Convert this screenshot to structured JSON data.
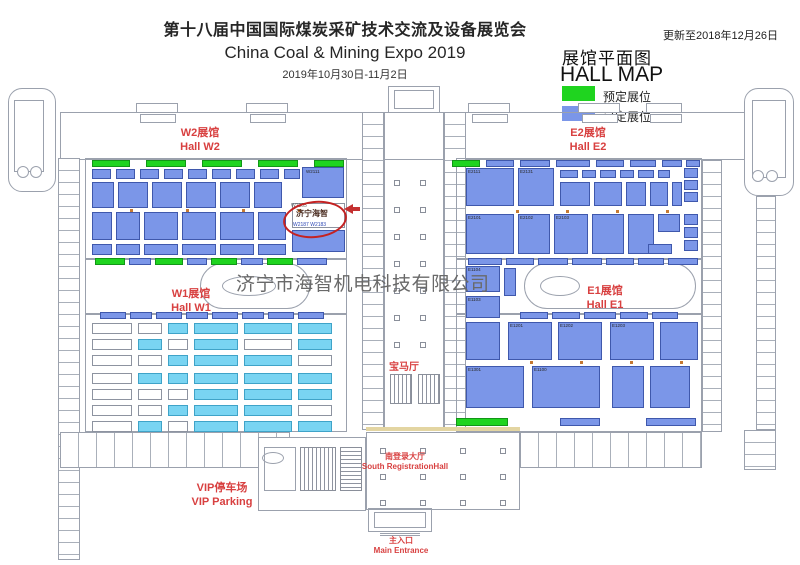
{
  "header": {
    "title_zh": "第十八届中国国际煤炭采矿技术交流及设备展览会",
    "title_en": "China Coal & Mining Expo 2019",
    "dates": "2019年10月30日-11月2日",
    "updated": "更新至2018年12月26日"
  },
  "legend": {
    "title_zh": "展馆平面图",
    "title_en": "HALL MAP",
    "items": [
      {
        "label": "预定展位",
        "color": "#1fd41f"
      },
      {
        "label": "已定展位",
        "color": "#7b96e8"
      }
    ]
  },
  "halls": {
    "w2": {
      "zh": "W2展馆",
      "en": "Hall W2"
    },
    "e2": {
      "zh": "E2展馆",
      "en": "Hall E2"
    },
    "w1": {
      "zh": "W1展馆",
      "en": "Hall W1"
    },
    "e1": {
      "zh": "E1展馆",
      "en": "Hall E1"
    }
  },
  "places": {
    "bmw_hall": "宝马厅",
    "south_hall_zh": "南登录大厅",
    "south_hall_en": "South RegistrationHall",
    "vip_zh": "VIP停车场",
    "vip_en": "VIP Parking",
    "entrance_zh": "主入口",
    "entrance_en": "Main Entrance"
  },
  "highlight": {
    "booth_no": "W2105",
    "company": "济宁海智",
    "neighbor_booths": "W2187  W2183"
  },
  "watermark": "济宁市海智机电科技有限公司",
  "map": {
    "booths": [
      [
        92,
        160,
        38,
        7,
        "g"
      ],
      [
        146,
        160,
        40,
        7,
        "g"
      ],
      [
        202,
        160,
        40,
        7,
        "g"
      ],
      [
        258,
        160,
        40,
        7,
        "g"
      ],
      [
        314,
        160,
        30,
        7,
        "g"
      ],
      [
        452,
        160,
        28,
        7,
        "g"
      ],
      [
        486,
        160,
        28,
        7,
        "b"
      ],
      [
        520,
        160,
        30,
        7,
        "b"
      ],
      [
        556,
        160,
        34,
        7,
        "b"
      ],
      [
        596,
        160,
        28,
        7,
        "b"
      ],
      [
        630,
        160,
        26,
        7,
        "b"
      ],
      [
        662,
        160,
        20,
        7,
        "b"
      ],
      [
        686,
        160,
        14,
        7,
        "b"
      ],
      [
        92,
        169,
        19,
        10,
        "b"
      ],
      [
        116,
        169,
        19,
        10,
        "b"
      ],
      [
        140,
        169,
        19,
        10,
        "b"
      ],
      [
        164,
        169,
        19,
        10,
        "b"
      ],
      [
        188,
        169,
        19,
        10,
        "b"
      ],
      [
        212,
        169,
        19,
        10,
        "b"
      ],
      [
        236,
        169,
        19,
        10,
        "b"
      ],
      [
        260,
        169,
        19,
        10,
        "b"
      ],
      [
        284,
        169,
        16,
        10,
        "b"
      ],
      [
        302,
        167,
        42,
        31,
        "b"
      ],
      [
        92,
        182,
        22,
        26,
        "b"
      ],
      [
        118,
        182,
        30,
        26,
        "b"
      ],
      [
        152,
        182,
        30,
        26,
        "b"
      ],
      [
        186,
        182,
        30,
        26,
        "b"
      ],
      [
        220,
        182,
        30,
        26,
        "b"
      ],
      [
        254,
        182,
        28,
        26,
        "b"
      ],
      [
        92,
        212,
        20,
        28,
        "b"
      ],
      [
        116,
        212,
        24,
        28,
        "b"
      ],
      [
        144,
        212,
        34,
        28,
        "b"
      ],
      [
        182,
        212,
        34,
        28,
        "b"
      ],
      [
        220,
        212,
        34,
        28,
        "b"
      ],
      [
        258,
        212,
        28,
        28,
        "b"
      ],
      [
        292,
        203,
        53,
        25,
        "w"
      ],
      [
        292,
        230,
        53,
        22,
        "b"
      ],
      [
        92,
        244,
        20,
        11,
        "b"
      ],
      [
        116,
        244,
        24,
        11,
        "b"
      ],
      [
        144,
        244,
        34,
        11,
        "b"
      ],
      [
        182,
        244,
        34,
        11,
        "b"
      ],
      [
        220,
        244,
        34,
        11,
        "b"
      ],
      [
        258,
        244,
        28,
        11,
        "b"
      ],
      [
        95,
        258,
        30,
        7,
        "g"
      ],
      [
        129,
        258,
        22,
        7,
        "b"
      ],
      [
        155,
        258,
        28,
        7,
        "g"
      ],
      [
        187,
        258,
        20,
        7,
        "b"
      ],
      [
        211,
        258,
        26,
        7,
        "g"
      ],
      [
        241,
        258,
        22,
        7,
        "b"
      ],
      [
        267,
        258,
        26,
        7,
        "g"
      ],
      [
        297,
        258,
        30,
        7,
        "b"
      ],
      [
        466,
        168,
        48,
        38,
        "b"
      ],
      [
        518,
        168,
        36,
        38,
        "b"
      ],
      [
        560,
        170,
        18,
        8,
        "b"
      ],
      [
        582,
        170,
        14,
        8,
        "b"
      ],
      [
        600,
        170,
        16,
        8,
        "b"
      ],
      [
        620,
        170,
        14,
        8,
        "b"
      ],
      [
        638,
        170,
        16,
        8,
        "b"
      ],
      [
        658,
        170,
        12,
        8,
        "b"
      ],
      [
        560,
        182,
        30,
        24,
        "b"
      ],
      [
        594,
        182,
        28,
        24,
        "b"
      ],
      [
        626,
        182,
        20,
        24,
        "b"
      ],
      [
        650,
        182,
        18,
        24,
        "b"
      ],
      [
        672,
        182,
        10,
        24,
        "b"
      ],
      [
        684,
        168,
        14,
        10,
        "b"
      ],
      [
        684,
        180,
        14,
        10,
        "b"
      ],
      [
        684,
        192,
        14,
        10,
        "b"
      ],
      [
        466,
        214,
        48,
        40,
        "b"
      ],
      [
        518,
        214,
        32,
        40,
        "b"
      ],
      [
        554,
        214,
        34,
        40,
        "b"
      ],
      [
        592,
        214,
        32,
        40,
        "b"
      ],
      [
        628,
        214,
        26,
        40,
        "b"
      ],
      [
        658,
        214,
        22,
        18,
        "b"
      ],
      [
        684,
        214,
        14,
        11,
        "b"
      ],
      [
        684,
        227,
        14,
        11,
        "b"
      ],
      [
        684,
        240,
        14,
        11,
        "b"
      ],
      [
        648,
        244,
        24,
        10,
        "b"
      ],
      [
        468,
        258,
        34,
        7,
        "b"
      ],
      [
        506,
        258,
        28,
        7,
        "b"
      ],
      [
        538,
        258,
        30,
        7,
        "b"
      ],
      [
        572,
        258,
        30,
        7,
        "b"
      ],
      [
        606,
        258,
        28,
        7,
        "b"
      ],
      [
        638,
        258,
        26,
        7,
        "b"
      ],
      [
        668,
        258,
        30,
        7,
        "b"
      ],
      [
        466,
        266,
        34,
        26,
        "b"
      ],
      [
        466,
        296,
        34,
        22,
        "b"
      ],
      [
        504,
        268,
        12,
        28,
        "b"
      ],
      [
        520,
        312,
        28,
        7,
        "b"
      ],
      [
        552,
        312,
        28,
        7,
        "b"
      ],
      [
        584,
        312,
        32,
        7,
        "b"
      ],
      [
        620,
        312,
        28,
        7,
        "b"
      ],
      [
        652,
        312,
        26,
        7,
        "b"
      ],
      [
        100,
        312,
        26,
        7,
        "b"
      ],
      [
        130,
        312,
        22,
        7,
        "b"
      ],
      [
        156,
        312,
        26,
        7,
        "b"
      ],
      [
        186,
        312,
        22,
        7,
        "b"
      ],
      [
        212,
        312,
        26,
        7,
        "b"
      ],
      [
        242,
        312,
        22,
        7,
        "b"
      ],
      [
        268,
        312,
        26,
        7,
        "b"
      ],
      [
        298,
        312,
        26,
        7,
        "b"
      ],
      [
        466,
        322,
        34,
        38,
        "b"
      ],
      [
        508,
        322,
        44,
        38,
        "b"
      ],
      [
        558,
        322,
        44,
        38,
        "b"
      ],
      [
        610,
        322,
        44,
        38,
        "b"
      ],
      [
        660,
        322,
        38,
        38,
        "b"
      ],
      [
        466,
        366,
        58,
        42,
        "b"
      ],
      [
        532,
        366,
        68,
        42,
        "b"
      ],
      [
        612,
        366,
        32,
        42,
        "b"
      ],
      [
        650,
        366,
        40,
        42,
        "b"
      ],
      [
        456,
        418,
        52,
        8,
        "g"
      ],
      [
        560,
        418,
        40,
        8,
        "b"
      ],
      [
        646,
        418,
        50,
        8,
        "b"
      ],
      [
        92,
        323,
        40,
        11,
        "w"
      ],
      [
        92,
        339,
        40,
        11,
        "w"
      ],
      [
        92,
        355,
        40,
        11,
        "w"
      ],
      [
        92,
        373,
        40,
        11,
        "w"
      ],
      [
        92,
        389,
        40,
        11,
        "w"
      ],
      [
        92,
        405,
        40,
        11,
        "w"
      ],
      [
        92,
        421,
        40,
        11,
        "w"
      ],
      [
        138,
        323,
        24,
        11,
        "w"
      ],
      [
        138,
        339,
        24,
        11,
        "c"
      ],
      [
        138,
        355,
        24,
        11,
        "w"
      ],
      [
        138,
        373,
        24,
        11,
        "c"
      ],
      [
        138,
        389,
        24,
        11,
        "w"
      ],
      [
        138,
        405,
        24,
        11,
        "w"
      ],
      [
        138,
        421,
        24,
        11,
        "c"
      ],
      [
        168,
        323,
        20,
        11,
        "c"
      ],
      [
        168,
        339,
        20,
        11,
        "w"
      ],
      [
        168,
        355,
        20,
        11,
        "c"
      ],
      [
        168,
        373,
        20,
        11,
        "c"
      ],
      [
        168,
        389,
        20,
        11,
        "w"
      ],
      [
        168,
        405,
        20,
        11,
        "c"
      ],
      [
        168,
        421,
        20,
        11,
        "w"
      ],
      [
        194,
        323,
        44,
        11,
        "c"
      ],
      [
        194,
        339,
        44,
        11,
        "c"
      ],
      [
        194,
        355,
        44,
        11,
        "c"
      ],
      [
        194,
        373,
        44,
        11,
        "c"
      ],
      [
        194,
        389,
        44,
        11,
        "c"
      ],
      [
        194,
        405,
        44,
        11,
        "c"
      ],
      [
        194,
        421,
        44,
        11,
        "c"
      ],
      [
        244,
        323,
        48,
        11,
        "c"
      ],
      [
        244,
        339,
        48,
        11,
        "w"
      ],
      [
        244,
        355,
        48,
        11,
        "c"
      ],
      [
        244,
        373,
        48,
        11,
        "c"
      ],
      [
        244,
        389,
        48,
        11,
        "c"
      ],
      [
        244,
        405,
        48,
        11,
        "c"
      ],
      [
        244,
        421,
        48,
        11,
        "c"
      ],
      [
        298,
        323,
        34,
        11,
        "c"
      ],
      [
        298,
        339,
        34,
        11,
        "c"
      ],
      [
        298,
        355,
        34,
        11,
        "w"
      ],
      [
        298,
        373,
        34,
        11,
        "c"
      ],
      [
        298,
        389,
        34,
        11,
        "c"
      ],
      [
        298,
        405,
        34,
        11,
        "w"
      ],
      [
        298,
        421,
        34,
        11,
        "c"
      ]
    ],
    "booth_labels": [
      {
        "t": "W2111",
        "x": 306,
        "y": 170
      },
      {
        "t": "E2111",
        "x": 468,
        "y": 170
      },
      {
        "t": "E2131",
        "x": 520,
        "y": 170
      },
      {
        "t": "E2101",
        "x": 468,
        "y": 216
      },
      {
        "t": "E2102",
        "x": 520,
        "y": 216
      },
      {
        "t": "E2103",
        "x": 556,
        "y": 216
      },
      {
        "t": "E1104",
        "x": 468,
        "y": 268
      },
      {
        "t": "E1103",
        "x": 468,
        "y": 298
      },
      {
        "t": "E1201",
        "x": 510,
        "y": 324
      },
      {
        "t": "E1202",
        "x": 560,
        "y": 324
      },
      {
        "t": "E1203",
        "x": 612,
        "y": 324
      },
      {
        "t": "E1301",
        "x": 468,
        "y": 368
      },
      {
        "t": "E1100",
        "x": 534,
        "y": 368
      }
    ],
    "dots": [
      [
        130,
        209
      ],
      [
        186,
        209
      ],
      [
        242,
        209
      ],
      [
        298,
        209
      ],
      [
        516,
        210
      ],
      [
        566,
        210
      ],
      [
        616,
        210
      ],
      [
        666,
        210
      ],
      [
        530,
        361
      ],
      [
        580,
        361
      ],
      [
        630,
        361
      ],
      [
        680,
        361
      ]
    ],
    "columns": [
      [
        394,
        180
      ],
      [
        394,
        207
      ],
      [
        394,
        234
      ],
      [
        394,
        261
      ],
      [
        394,
        288
      ],
      [
        394,
        315
      ],
      [
        394,
        342
      ],
      [
        420,
        180
      ],
      [
        420,
        207
      ],
      [
        420,
        234
      ],
      [
        420,
        261
      ],
      [
        420,
        288
      ],
      [
        420,
        315
      ],
      [
        420,
        342
      ],
      [
        380,
        448
      ],
      [
        420,
        448
      ],
      [
        460,
        448
      ],
      [
        500,
        448
      ],
      [
        380,
        474
      ],
      [
        420,
        474
      ],
      [
        460,
        474
      ],
      [
        500,
        474
      ],
      [
        380,
        500
      ],
      [
        420,
        500
      ],
      [
        460,
        500
      ],
      [
        500,
        500
      ]
    ]
  }
}
